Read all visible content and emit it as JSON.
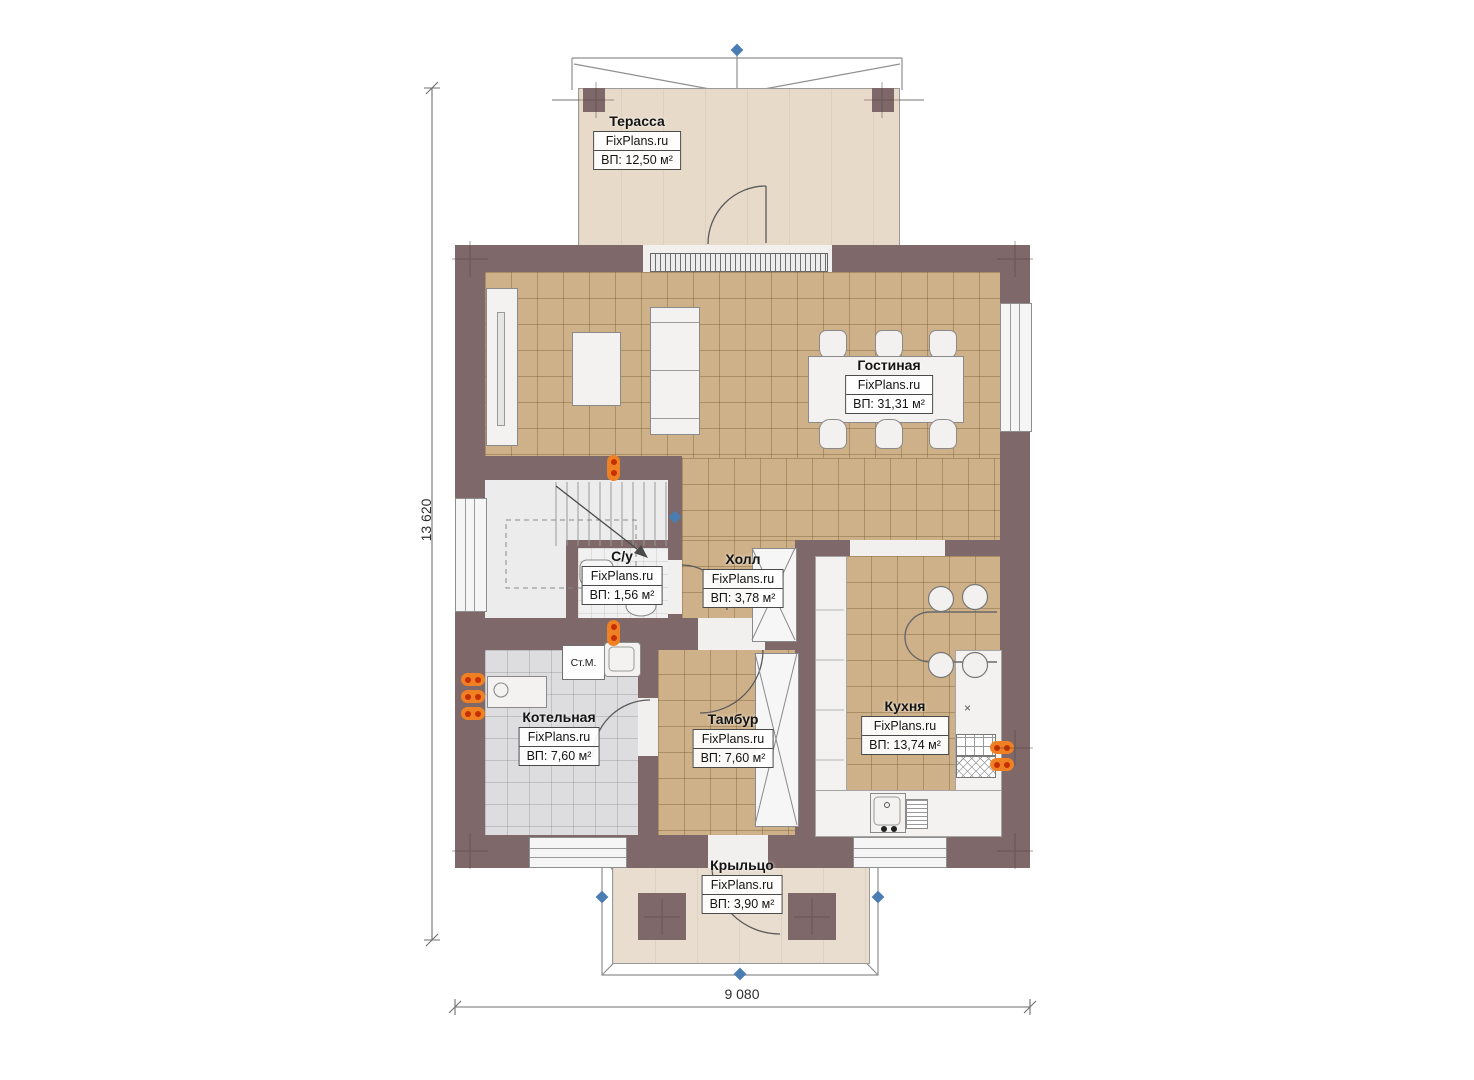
{
  "brand": "FixPlans.ru",
  "dimensions": {
    "height_mm": "13 620",
    "width_mm": "9 080"
  },
  "rooms": {
    "terrace": {
      "name": "Терасса",
      "brand": "FixPlans.ru",
      "area": "ВП: 12,50 м²"
    },
    "living": {
      "name": "Гостиная",
      "brand": "FixPlans.ru",
      "area": "ВП: 31,31 м²"
    },
    "wc": {
      "name": "С/у",
      "brand": "FixPlans.ru",
      "area": "ВП: 1,56 м²"
    },
    "hall": {
      "name": "Холл",
      "brand": "FixPlans.ru",
      "area": "ВП: 3,78 м²"
    },
    "boiler": {
      "name": "Котельная",
      "brand": "FixPlans.ru",
      "area": "ВП: 7,60 м²"
    },
    "tambur": {
      "name": "Тамбур",
      "brand": "FixPlans.ru",
      "area": "ВП: 7,60 м²"
    },
    "kitchen": {
      "name": "Кухня",
      "brand": "FixPlans.ru",
      "area": "ВП: 13,74 м²"
    },
    "porch": {
      "name": "Крыльцо",
      "brand": "FixPlans.ru",
      "area": "ВП: 3,90 м²"
    }
  },
  "labels": {
    "washing_machine": "Ст.М.",
    "stove_mark": "×"
  },
  "colors": {
    "wall": "#7e6869",
    "floor_tile_tan": "#cfb189",
    "floor_tile_gray": "#dddddf",
    "floor_terrace": "#e7dac9",
    "radiator_orange": "#f08024",
    "radiator_dot": "#c62f00",
    "marker_blue": "#4a7db2"
  }
}
